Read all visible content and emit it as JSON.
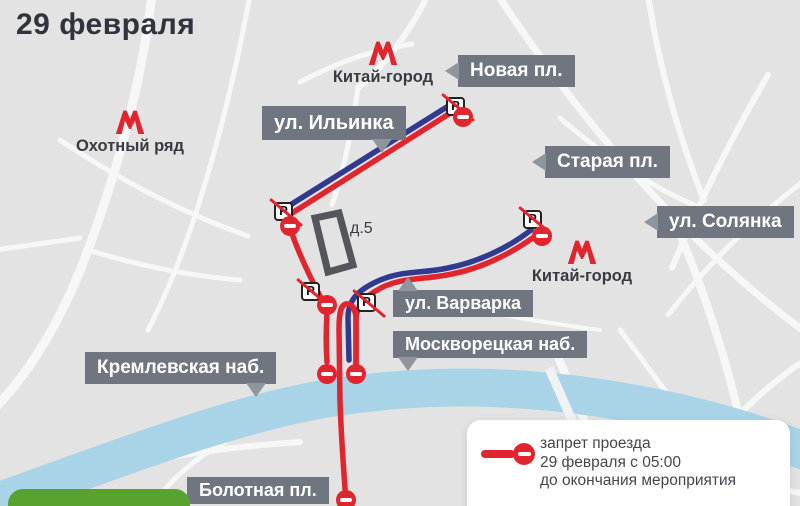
{
  "title": "29 февраля",
  "colors": {
    "map_background": "#e3e3e3",
    "street_white": "#f7f7f7",
    "river_blue": "#a9d4e7",
    "closed_road_red": "#e1252e",
    "route_blue": "#303a8e",
    "label_box_gray": "#6f7680",
    "pointer_gray": "#8f959d",
    "metro_red": "#e1252e",
    "green_area": "#58a330",
    "building_outline": "#55565c"
  },
  "metro_stations": [
    {
      "name": "kitay-gorod-north",
      "label": "Китай-город"
    },
    {
      "name": "okhotny-ryad",
      "label": "Охотный ряд"
    },
    {
      "name": "kitay-gorod-east",
      "label": "Китай-город"
    }
  ],
  "street_labels": [
    {
      "name": "novaya-pl",
      "text": "Новая пл."
    },
    {
      "name": "ilyinka",
      "text": "ул. Ильинка"
    },
    {
      "name": "staraya-pl",
      "text": "Старая пл."
    },
    {
      "name": "solyanka",
      "text": "ул. Солянка"
    },
    {
      "name": "varvarka",
      "text": "ул. Варварка"
    },
    {
      "name": "moskvoretskaya-nab",
      "text": "Москворецкая наб."
    },
    {
      "name": "kremlevskaya-nab",
      "text": "Кремлевская наб."
    },
    {
      "name": "bolotnaya-pl",
      "text": "Болотная пл."
    }
  ],
  "building": {
    "label": "д.5"
  },
  "parking_sign_letter": "P",
  "legend": {
    "lines": [
      "запрет проезда",
      "29 февраля с 05:00",
      "до окончания мероприятия"
    ]
  }
}
